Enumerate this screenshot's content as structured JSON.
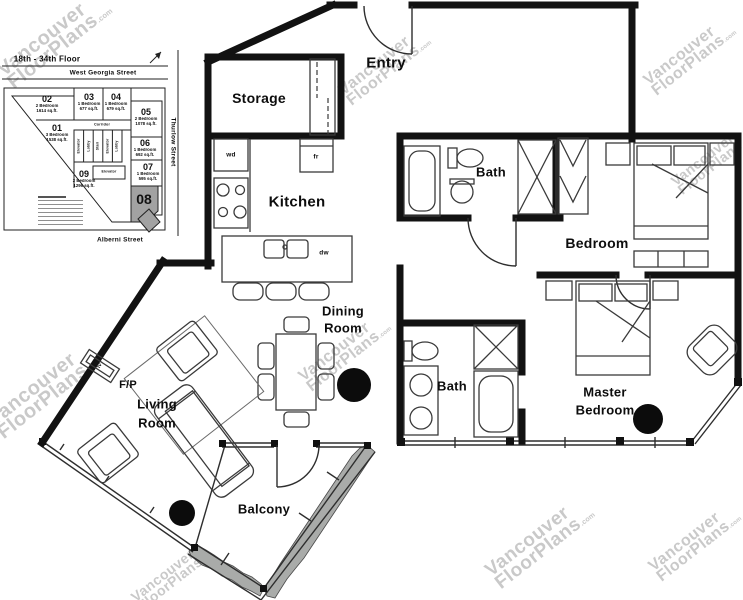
{
  "watermark": {
    "line1": "Vancouver",
    "line2": "FloorPlans",
    "suffix": ".com"
  },
  "key_plan": {
    "floor_range": "18th - 34th Floor",
    "streets": {
      "top": "West Georgia Street",
      "right": "Thurlow Street",
      "bottom": "Alberni Street"
    },
    "units": [
      {
        "id": "01",
        "type": "3 Bedroom",
        "area": "1538 sq.ft."
      },
      {
        "id": "02",
        "type": "2 Bedroom",
        "area": "1614 sq.ft."
      },
      {
        "id": "03",
        "type": "1 Bedroom",
        "area": "677 sq.ft."
      },
      {
        "id": "04",
        "type": "1 Bedroom",
        "area": "679 sq.ft."
      },
      {
        "id": "05",
        "type": "2 Bedroom",
        "area": "1078 sq.ft."
      },
      {
        "id": "06",
        "type": "1 Bedroom",
        "area": "692 sq.ft."
      },
      {
        "id": "07",
        "type": "1 Bedroom",
        "area": "595 sq.ft."
      },
      {
        "id": "08",
        "type": "",
        "area": "",
        "highlighted": true
      },
      {
        "id": "09",
        "type": "2 Bedroom",
        "area": "1296 sq.ft."
      }
    ],
    "core": {
      "corridor": "Corridor",
      "cells": [
        "Elevator",
        "Lobby",
        "Stair",
        "Elevator",
        "Lobby"
      ],
      "vestibule": "Elevator"
    }
  },
  "rooms": {
    "entry": "Entry",
    "storage": "Storage",
    "kitchen": "Kitchen",
    "bath1": "Bath",
    "bedroom": "Bedroom",
    "dining_line1": "Dining",
    "dining_line2": "Room",
    "bath2": "Bath",
    "master_line1": "Master",
    "master_line2": "Bedroom",
    "living_line1": "Living",
    "living_line2": "Room",
    "fireplace": "F/P",
    "balcony": "Balcony"
  },
  "appliances": {
    "washer_dryer": "wd",
    "fridge": "fr",
    "dishwasher": "dw",
    "tv": "tv"
  },
  "colors": {
    "wall": "#121212",
    "planter_fill": "#a9aba9",
    "unit_highlight": "#a2a2a2",
    "watermark": "#c9c9c9"
  }
}
